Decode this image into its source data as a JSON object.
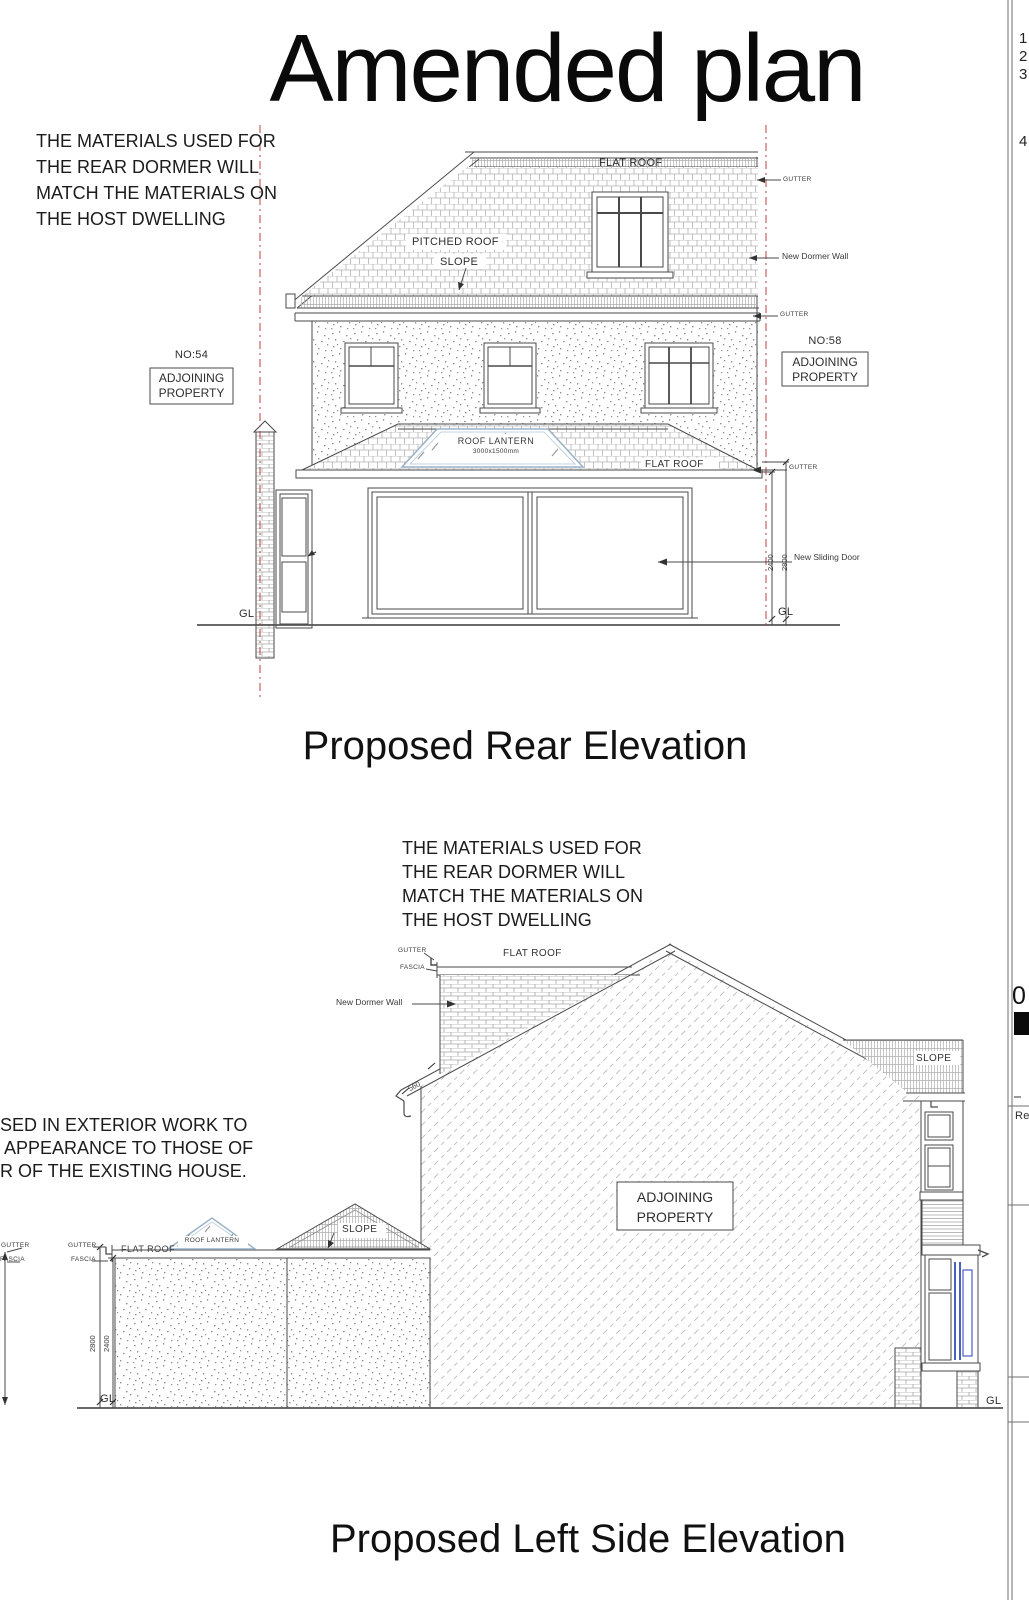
{
  "title": "Amended plan",
  "materials_note": {
    "line1": "THE MATERIALS USED FOR",
    "line2": "THE REAR DORMER WILL",
    "line3": "MATCH THE MATERIALS ON",
    "line4": "THE HOST DWELLING"
  },
  "rear_elevation": {
    "caption": "Proposed Rear Elevation",
    "labels": {
      "flat_roof_top": "FLAT ROOF",
      "gutter_top": "GUTTER",
      "pitched_roof": "PITCHED ROOF",
      "slope": "SLOPE",
      "new_dormer_wall": "New Dormer Wall",
      "gutter_eaves": "GUTTER",
      "no54": "NO:54",
      "adjoining_left_1": "ADJOINING",
      "adjoining_left_2": "PROPERTY",
      "no58": "NO:58",
      "adjoining_right_1": "ADJOINING",
      "adjoining_right_2": "PROPERTY",
      "roof_lantern": "ROOF LANTERN",
      "roof_lantern_size": "3000x1500mm",
      "flat_roof_ext": "FLAT ROOF",
      "gutter_ext": "GUTTER",
      "dim_2400": "2400",
      "dim_2800": "2800",
      "new_sliding_door": "New Sliding Door",
      "gl_left": "GL",
      "gl_right": "GL"
    }
  },
  "side_elevation": {
    "caption": "Proposed Left Side Elevation",
    "cut_note": {
      "line1": "SED IN EXTERIOR WORK TO",
      "line2": "APPEARANCE TO THOSE OF",
      "line3": "R OF THE EXISTING HOUSE."
    },
    "labels": {
      "gutter_dormer": "GUTTER",
      "fascia_dormer": "FASCIA",
      "flat_roof_dormer": "FLAT ROOF",
      "new_dormer_wall": "New Dormer Wall",
      "dim_560": "560",
      "gutter_far_left": "GUTTER",
      "fascia_far_left": "FASCIA",
      "gutter_left": "GUTTER",
      "fascia_left": "FASCIA",
      "flat_roof_ext": "FLAT ROOF",
      "roof_lantern": "ROOF LANTERN",
      "slope_gable": "SLOPE",
      "slope_right": "SLOPE",
      "adjoining_1": "ADJOINING",
      "adjoining_2": "PROPERTY",
      "dim_2800": "2800",
      "dim_2400": "2400",
      "gl_left": "GL",
      "gl_right": "GL"
    }
  },
  "title_block": {
    "digits": [
      "1",
      "2",
      "3",
      "4"
    ],
    "zero": "0",
    "rev": "Re"
  },
  "colors": {
    "boundary_red": "#b84040",
    "lantern_blue": "#9ab2c8",
    "window_blue": "#4a5fc0",
    "line": "#4a4a4a"
  }
}
